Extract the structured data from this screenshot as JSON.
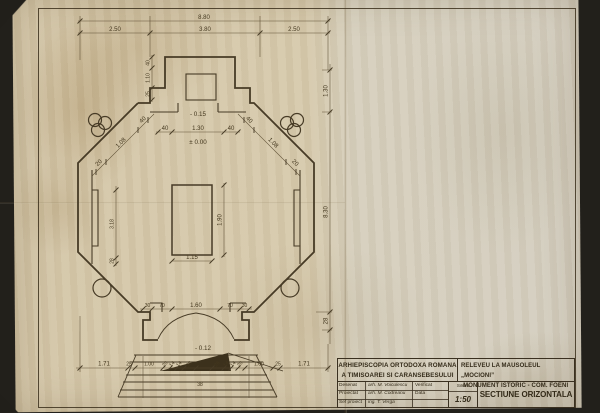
{
  "colors": {
    "paper": "#d6c9ac",
    "background": "#22201b",
    "ink": "#473b26"
  },
  "plan": {
    "levels": {
      "upper": "- 0.15",
      "zero": "± 0.00",
      "entry": "- 0.12"
    },
    "dims": {
      "top_overall": "8.80",
      "top_a": "2.50",
      "top_b": "3.80",
      "top_c": "2.50",
      "right_a": "1.30",
      "right_b": "8.30",
      "right_c": "28",
      "top_inner_a": "40",
      "top_inner_b": "1.30",
      "top_inner_c": "40",
      "diag_tl_a": "20",
      "diag_tl_b": "1.08",
      "diag_tl_c": "40",
      "diag_tr_a": "40",
      "diag_tr_b": "1.08",
      "diag_tr_c": "20",
      "crypt_w": "1.15",
      "crypt_h": "1.90",
      "door_a": "30",
      "door_b": "70",
      "door_c": "1.60",
      "door_d": "70",
      "door_e": "30",
      "vest_a": "40",
      "vest_b": "1.10",
      "vest_c": "25",
      "side_a": "3.18",
      "side_b": "28",
      "bot_a": "1.71",
      "bot_b": "25",
      "bot_c": "1.00",
      "bot_d": "20",
      "bot_e": "14",
      "bot_f": "14",
      "bot_g": "26",
      "bot_h": "26",
      "bot_i": "14",
      "bot_j": "14",
      "bot_k": "20",
      "bot_l": "1.00",
      "bot_m": "25",
      "bot_n": "1.71",
      "steps_riser": "38"
    }
  },
  "title_block": {
    "org_line1": "ARHIEPISCOPIA ORTODOXA ROMANA",
    "org_line2": "A TIMISOAREI SI CARANSEBESULUI",
    "project_line1": "RELEVEU LA MAUSOLEUL „MOCIONI”",
    "project_line2": "-MONUMENT ISTORIC - COM. FOENI",
    "row1_role": "Desenat",
    "row1_name": "arh. M. Voiculescu",
    "row1_extra": "Verificat",
    "row2_role": "Proiectat",
    "row2_name": "arh. M. Codreanu",
    "row2_extra": "Data",
    "row3_role": "Sef proiect",
    "row3_name": "ing. T. Verga",
    "row3_extra": "",
    "scale_label": "Scara",
    "scale_value": "1:50",
    "drawing_title": "SECTIUNE ORIZONTALA"
  }
}
